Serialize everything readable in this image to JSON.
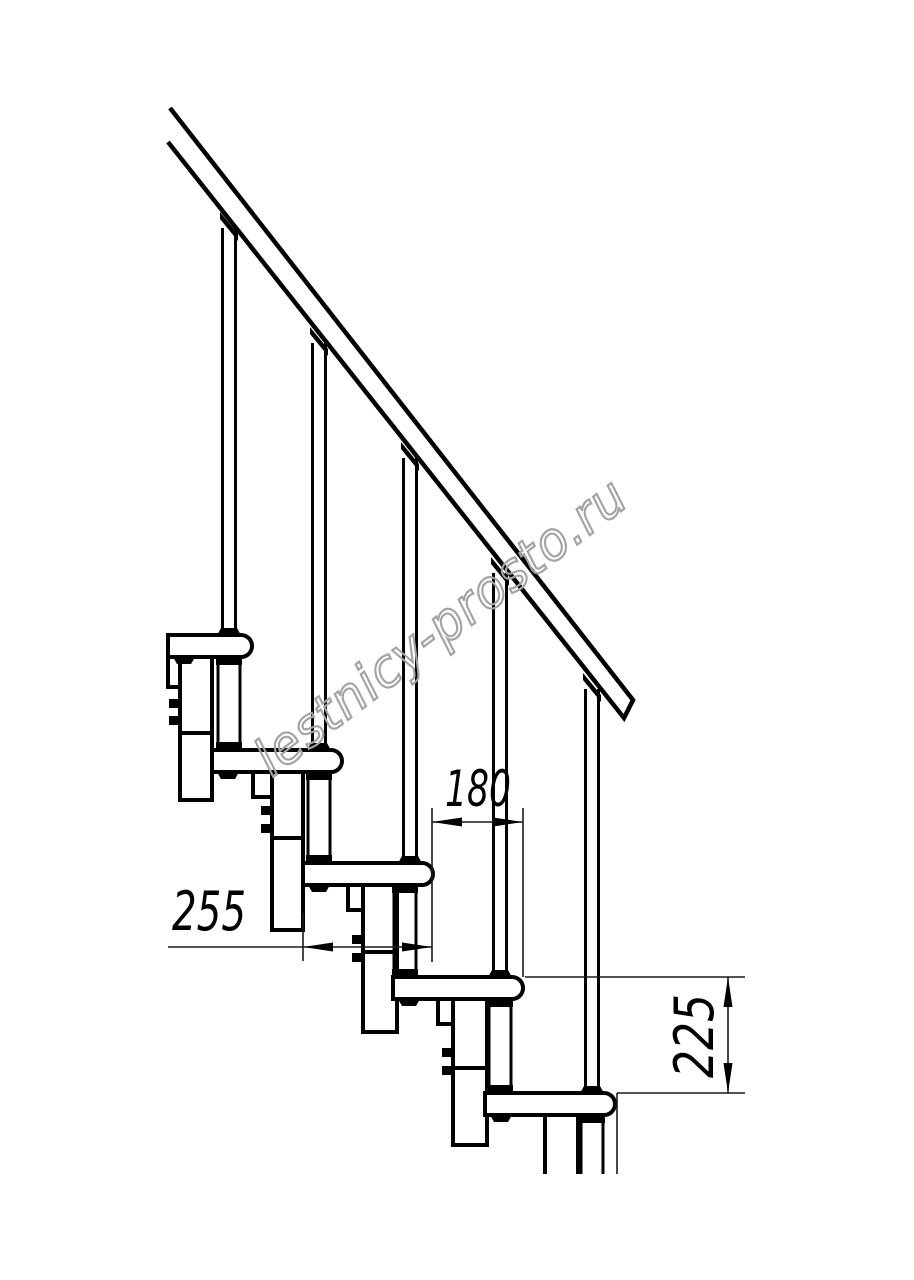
{
  "drawing": {
    "type": "technical-drawing",
    "subject": "modular staircase side elevation",
    "background_color": "#ffffff",
    "line_color": "#000000",
    "dimension_color": "#1a1a1a",
    "watermark": {
      "text": "lestnicy-prosto.ru",
      "color": "#a3a3a3"
    },
    "dimensions": {
      "step_run": {
        "value": "180",
        "orientation": "horizontal"
      },
      "tread_depth": {
        "value": "255",
        "orientation": "horizontal"
      },
      "step_rise": {
        "value": "225",
        "orientation": "vertical"
      }
    },
    "parts": {
      "handrail": "handrail",
      "balusters_count": 5,
      "treads_count": 5,
      "support_posts_count": 5,
      "stringer_modules_count": 5
    }
  }
}
